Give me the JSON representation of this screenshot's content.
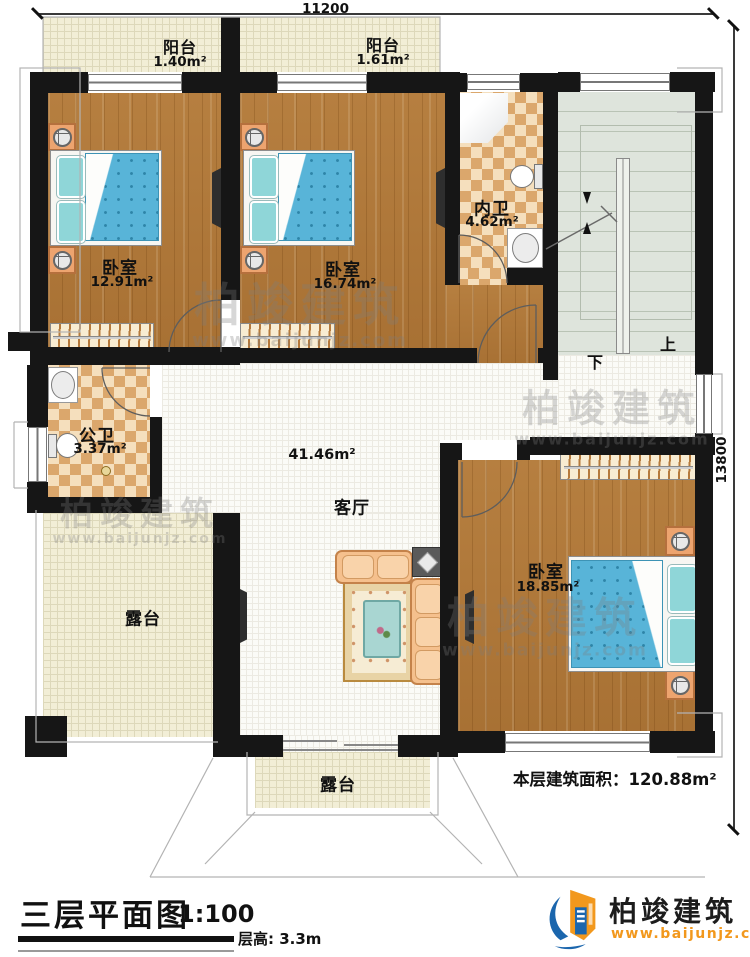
{
  "dimensions": {
    "top": "11200",
    "right": "13800"
  },
  "rooms": {
    "balcony1": {
      "label": "阳台",
      "area": "1.40m²"
    },
    "balcony2": {
      "label": "阳台",
      "area": "1.61m²"
    },
    "bedroom1": {
      "label": "卧室",
      "area": "12.91m²"
    },
    "bedroom2": {
      "label": "卧室",
      "area": "16.74m²"
    },
    "ensuite_bath": {
      "label": "内卫",
      "area": "4.62m²"
    },
    "public_bath": {
      "label": "公卫",
      "area": "3.37m²"
    },
    "living": {
      "label": "客厅",
      "area": "41.46m²"
    },
    "bedroom3": {
      "label": "卧室",
      "area": "18.85m²"
    },
    "terrace_left": {
      "label": "露台"
    },
    "terrace_bottom": {
      "label": "露台"
    }
  },
  "stairs": {
    "up": "上",
    "down": "下"
  },
  "notes": {
    "floor_area": "本层建筑面积：120.88m²"
  },
  "title_block": {
    "title": "三层平面图",
    "scale": "1:100",
    "floor_height": "层高: 3.3m"
  },
  "logo": {
    "name": "柏竣建筑",
    "website": "www.baijunjz.com"
  },
  "watermark": {
    "name": "柏竣建筑",
    "website": "www.baijunjz.com"
  },
  "colors": {
    "wall": "#161616",
    "wood": "#b07a3c",
    "tile_light": "#f5dfbd",
    "tile_dark": "#dba76c",
    "bed_blue": "#58b4d8",
    "terrace": "#f2eed6",
    "stair": "#dee4dc",
    "logo_blue": "#1b66ad",
    "logo_orange": "#f2981d"
  }
}
